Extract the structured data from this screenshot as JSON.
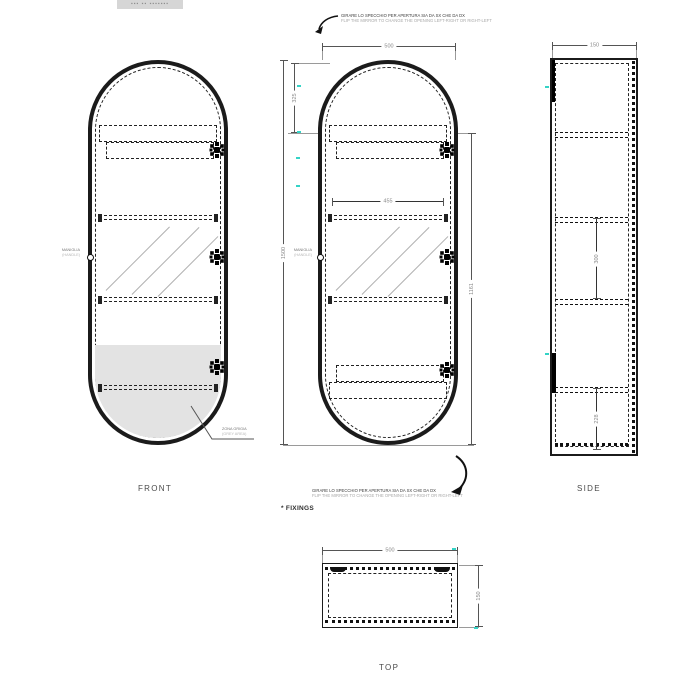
{
  "logo_text": "▪▪▪ ▪▪ ▪▪▪▪▪▪▪",
  "notes": {
    "mirror_note_it": "GIRARE LO SPECCHIO PER APERTURA SIA DA SX CHE DA DX",
    "mirror_note_en": "FLIP THE MIRROR TO CHANGE THE OPENING LEFT-RIGHT OR RIGHT-LEFT",
    "fixings_note": "* FIXINGS",
    "handle_it": "MANIGLIA",
    "handle_en": "(HANDLE)",
    "grey_it": "ZONA GRIGIA",
    "grey_en": "(GREY AREA)"
  },
  "views": {
    "front": {
      "label": "FRONT"
    },
    "side": {
      "label": "SIDE"
    },
    "top": {
      "label": "TOP"
    }
  },
  "dimensions": {
    "width": "500",
    "top_offset": "325",
    "height": "1500",
    "inner_width": "455",
    "door_height": "1161",
    "depth": "150",
    "shelf_mid": "300",
    "shelf_bottom": "228",
    "top_width": "500",
    "top_depth": "150"
  },
  "colors": {
    "line": "#1b1b1b",
    "dim_text": "#8a8a8a",
    "accent_cyan": "#35d3c6",
    "shade_gray": "#e3e3e3"
  }
}
